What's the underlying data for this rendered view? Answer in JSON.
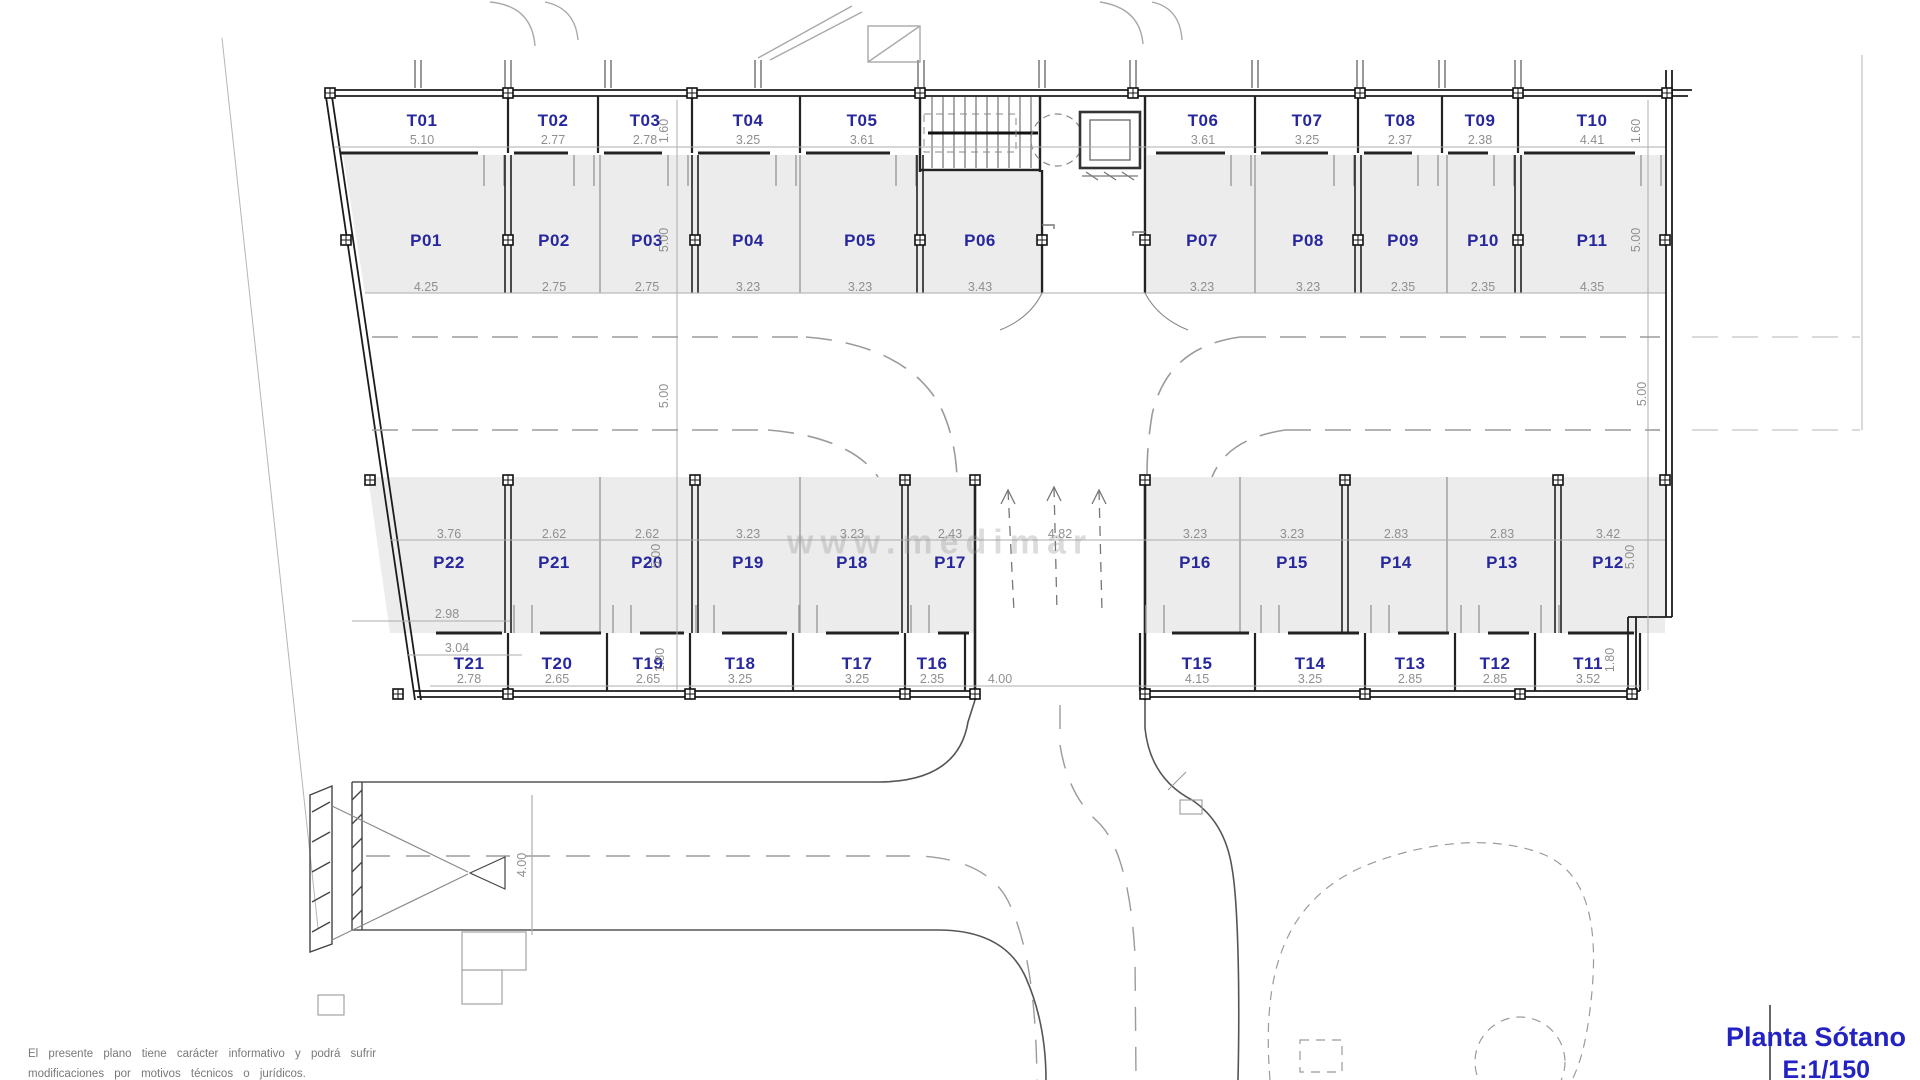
{
  "title_block": {
    "name": "Planta Sótano",
    "scale": "E:1/150"
  },
  "disclaimer": {
    "line1": "El presente plano tiene carácter informativo y podrá sufrir",
    "line2": "modificaciones por motivos técnicos o jurídicos."
  },
  "watermark": "www.medimar",
  "colors": {
    "label_blue": "#27279e",
    "dim_gray": "#8f8f8f",
    "title_blue": "#2323c4",
    "parking_fill": "#ececec"
  },
  "storage_top": [
    {
      "id": "T01",
      "w": "5.10"
    },
    {
      "id": "T02",
      "w": "2.77"
    },
    {
      "id": "T03",
      "w": "2.78"
    },
    {
      "id": "T04",
      "w": "3.25"
    },
    {
      "id": "T05",
      "w": "3.61"
    },
    {
      "id": "T06",
      "w": "3.61"
    },
    {
      "id": "T07",
      "w": "3.25"
    },
    {
      "id": "T08",
      "w": "2.37"
    },
    {
      "id": "T09",
      "w": "2.38"
    },
    {
      "id": "T10",
      "w": "4.41"
    }
  ],
  "parking_top": [
    {
      "id": "P01",
      "w": "4.25"
    },
    {
      "id": "P02",
      "w": "2.75"
    },
    {
      "id": "P03",
      "w": "2.75"
    },
    {
      "id": "P04",
      "w": "3.23"
    },
    {
      "id": "P05",
      "w": "3.23"
    },
    {
      "id": "P06",
      "w": "3.43"
    },
    {
      "id": "P07",
      "w": "3.23"
    },
    {
      "id": "P08",
      "w": "3.23"
    },
    {
      "id": "P09",
      "w": "2.35"
    },
    {
      "id": "P10",
      "w": "2.35"
    },
    {
      "id": "P11",
      "w": "4.35"
    }
  ],
  "parking_bottom": [
    {
      "id": "P22",
      "w": "3.76"
    },
    {
      "id": "P21",
      "w": "2.62"
    },
    {
      "id": "P20",
      "w": "2.62"
    },
    {
      "id": "P19",
      "w": "3.23"
    },
    {
      "id": "P18",
      "w": "3.23"
    },
    {
      "id": "P17",
      "w": "2.43"
    },
    {
      "id": "P16",
      "w": "3.23"
    },
    {
      "id": "P15",
      "w": "3.23"
    },
    {
      "id": "P14",
      "w": "2.83"
    },
    {
      "id": "P13",
      "w": "2.83"
    },
    {
      "id": "P12",
      "w": "3.42"
    }
  ],
  "storage_bottom": [
    {
      "id": "T21",
      "w": "2.78"
    },
    {
      "id": "T20",
      "w": "2.65"
    },
    {
      "id": "T19",
      "w": "2.65"
    },
    {
      "id": "T18",
      "w": "3.25"
    },
    {
      "id": "T17",
      "w": "3.25"
    },
    {
      "id": "T16",
      "w": "2.35"
    },
    {
      "id": "T15",
      "w": "4.15"
    },
    {
      "id": "T14",
      "w": "3.25"
    },
    {
      "id": "T13",
      "w": "2.85"
    },
    {
      "id": "T12",
      "w": "2.85"
    },
    {
      "id": "T11",
      "w": "3.52"
    }
  ],
  "dims": {
    "left_chain": [
      "1.60",
      "5.00",
      "5.00",
      "5.00",
      "1.80"
    ],
    "right_chain": [
      "1.60",
      "5.00",
      "5.00",
      "5.00",
      "1.80"
    ],
    "ramp_width": "4.82",
    "ramp_bottom_width": "4.00",
    "road_width": "4.00",
    "sub_dim_1": "2.98",
    "sub_dim_2": "3.04"
  }
}
